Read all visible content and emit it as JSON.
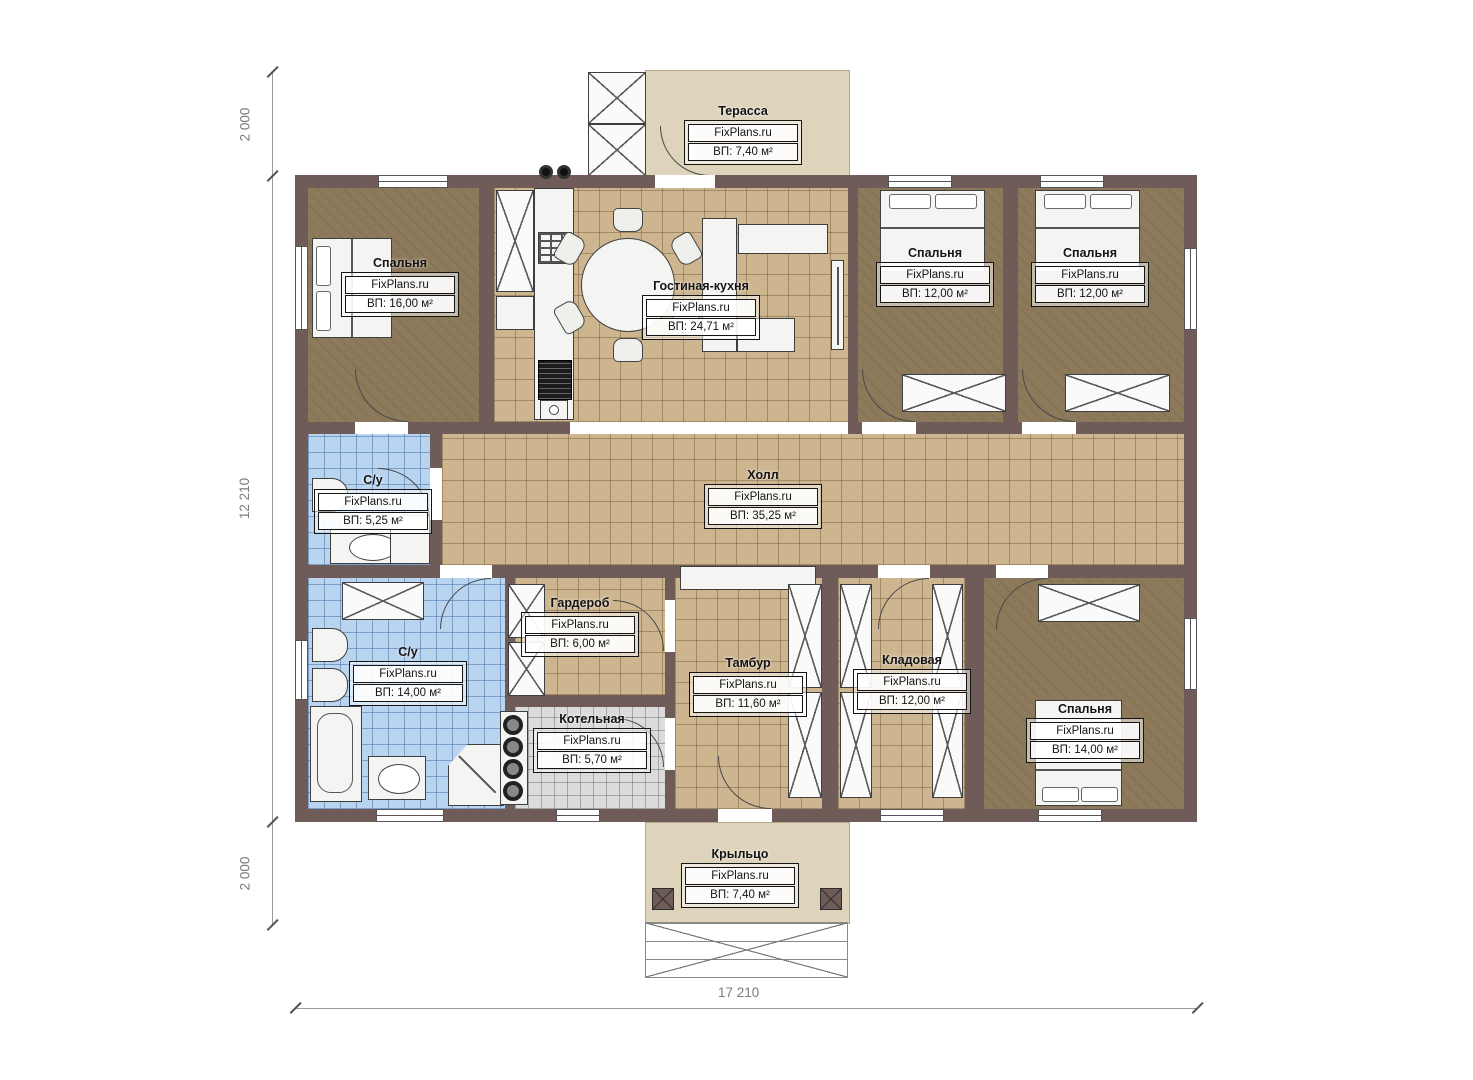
{
  "site_brand": "FixPlans.ru",
  "dimensions": {
    "left_top": "2 000",
    "left_middle": "12 210",
    "left_bottom": "2 000",
    "bottom_total": "17 210"
  },
  "rooms": [
    {
      "key": "terrace",
      "name": "Терасса",
      "brand": "FixPlans.ru",
      "area": "ВП: 7,40 м²"
    },
    {
      "key": "bedroom-1",
      "name": "Спальня",
      "brand": "FixPlans.ru",
      "area": "ВП: 16,00 м²"
    },
    {
      "key": "living-kitchen",
      "name": "Гостиная-кухня",
      "brand": "FixPlans.ru",
      "area": "ВП: 24,71 м²"
    },
    {
      "key": "bedroom-2",
      "name": "Спальня",
      "brand": "FixPlans.ru",
      "area": "ВП: 12,00 м²"
    },
    {
      "key": "bedroom-3",
      "name": "Спальня",
      "brand": "FixPlans.ru",
      "area": "ВП: 12,00 м²"
    },
    {
      "key": "hall",
      "name": "Холл",
      "brand": "FixPlans.ru",
      "area": "ВП: 35,25 м²"
    },
    {
      "key": "bathroom-small",
      "name": "С/у",
      "brand": "FixPlans.ru",
      "area": "ВП: 5,25 м²"
    },
    {
      "key": "bathroom-large",
      "name": "С/у",
      "brand": "FixPlans.ru",
      "area": "ВП: 14,00 м²"
    },
    {
      "key": "wardrobe",
      "name": "Гардероб",
      "brand": "FixPlans.ru",
      "area": "ВП: 6,00 м²"
    },
    {
      "key": "boiler-room",
      "name": "Котельная",
      "brand": "FixPlans.ru",
      "area": "ВП: 5,70 м²"
    },
    {
      "key": "vestibule",
      "name": "Тамбур",
      "brand": "FixPlans.ru",
      "area": "ВП: 11,60 м²"
    },
    {
      "key": "storage",
      "name": "Кладовая",
      "brand": "FixPlans.ru",
      "area": "ВП: 12,00 м²"
    },
    {
      "key": "bedroom-4",
      "name": "Спальня",
      "brand": "FixPlans.ru",
      "area": "ВП: 14,00 м²"
    },
    {
      "key": "porch",
      "name": "Крыльцо",
      "brand": "FixPlans.ru",
      "area": "ВП: 7,40 м²"
    }
  ],
  "colors": {
    "wall": "#6f5b57",
    "floor_wood": "#8d7a5b",
    "floor_tile_tan": "#cdb58f",
    "floor_tile_blue": "#b9d4ef",
    "floor_tile_gray": "#dbdbdb",
    "outdoor": "#ded3bb",
    "background": "#ffffff"
  }
}
